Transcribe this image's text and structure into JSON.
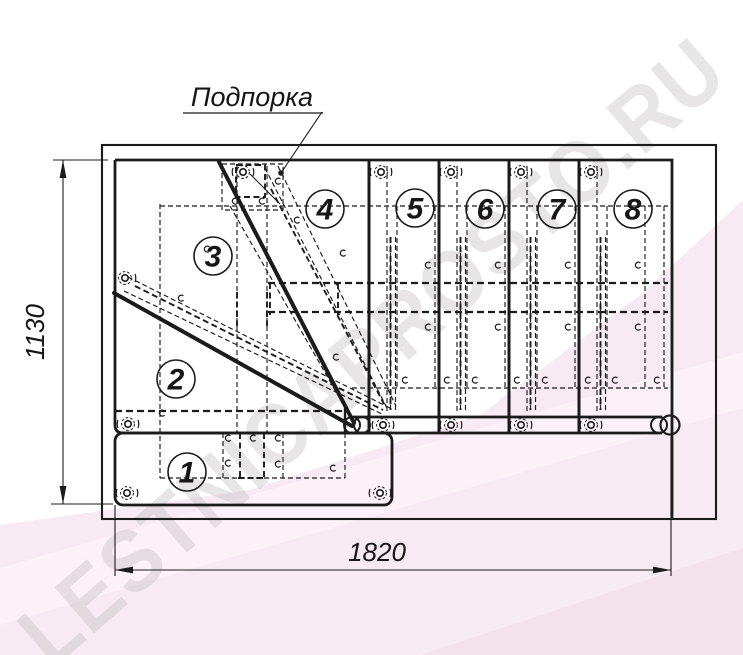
{
  "drawing": {
    "callout_label": "Подпорка",
    "width_dimension": "1820",
    "height_dimension": "1130",
    "step_labels": [
      "1",
      "2",
      "3",
      "4",
      "5",
      "6",
      "7",
      "8"
    ]
  },
  "watermark_text": "LESTNICAPROSTO.RU",
  "colors": {
    "line": "#1b1b1b",
    "paper": "#ffffff",
    "pink_band": "#f7eaf2",
    "pink_band_dark": "#f3e2ec",
    "pink_band_light": "#fbf2f8",
    "watermark_gray": "#c7c3c6"
  }
}
